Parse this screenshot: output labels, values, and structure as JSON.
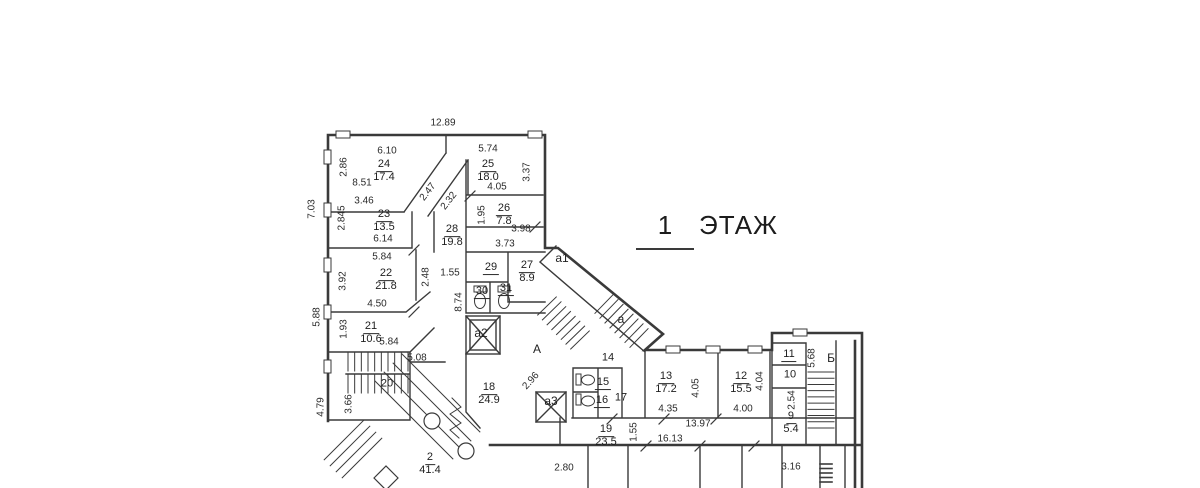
{
  "title": {
    "number": "1",
    "word": "ЭТАЖ"
  },
  "colors": {
    "background": "#ffffff",
    "line": "#3a3a3a",
    "text": "#2a2a2a"
  },
  "plan": {
    "rooms": [
      {
        "n": "24",
        "a": "17.4",
        "x": 384,
        "y": 169
      },
      {
        "n": "25",
        "a": "18.0",
        "x": 488,
        "y": 169
      },
      {
        "n": "23",
        "a": "13.5",
        "x": 384,
        "y": 219
      },
      {
        "n": "26",
        "a": "7.8",
        "x": 504,
        "y": 213
      },
      {
        "n": "28",
        "a": "19.8",
        "x": 452,
        "y": 234
      },
      {
        "n": "22",
        "a": "21.8",
        "x": 386,
        "y": 278
      },
      {
        "n": "21",
        "a": "10.6",
        "x": 371,
        "y": 331
      },
      {
        "n": "27",
        "a": "8.9",
        "x": 527,
        "y": 270
      },
      {
        "n": "29",
        "a": null,
        "u": true,
        "x": 491,
        "y": 266
      },
      {
        "n": "30",
        "a": null,
        "u": true,
        "x": 482,
        "y": 290
      },
      {
        "n": "31",
        "a": null,
        "u": true,
        "x": 506,
        "y": 287
      },
      {
        "n": "20",
        "a": null,
        "x": 387,
        "y": 382
      },
      {
        "n": "18",
        "a": "24.9",
        "x": 489,
        "y": 392
      },
      {
        "n": "2",
        "a": "41.4",
        "x": 430,
        "y": 462
      },
      {
        "n": "14",
        "a": null,
        "x": 608,
        "y": 356
      },
      {
        "n": "15",
        "a": null,
        "u": true,
        "x": 603,
        "y": 381
      },
      {
        "n": "16",
        "a": null,
        "u": true,
        "x": 602,
        "y": 399
      },
      {
        "n": "17",
        "a": null,
        "x": 621,
        "y": 396
      },
      {
        "n": "13",
        "a": "17.2",
        "x": 666,
        "y": 381
      },
      {
        "n": "12",
        "a": "15.5",
        "x": 741,
        "y": 381
      },
      {
        "n": "19",
        "a": "23.5",
        "x": 606,
        "y": 434
      },
      {
        "n": "11",
        "a": null,
        "u": true,
        "x": 789,
        "y": 353
      },
      {
        "n": "10",
        "a": null,
        "x": 790,
        "y": 373
      },
      {
        "n": "9",
        "a": "5.4",
        "x": 791,
        "y": 421
      }
    ],
    "dims": [
      {
        "t": "12.89",
        "x": 443,
        "y": 123,
        "r": 0
      },
      {
        "t": "7.03",
        "x": 312,
        "y": 209,
        "r": -90
      },
      {
        "t": "5.88",
        "x": 317,
        "y": 317,
        "r": -90
      },
      {
        "t": "4.79",
        "x": 321,
        "y": 407,
        "r": -90
      },
      {
        "t": "6.10",
        "x": 387,
        "y": 151,
        "r": 0
      },
      {
        "t": "2.86",
        "x": 344,
        "y": 167,
        "r": -90
      },
      {
        "t": "8.51",
        "x": 362,
        "y": 183,
        "r": 0
      },
      {
        "t": "3.46",
        "x": 364,
        "y": 201,
        "r": 0
      },
      {
        "t": "2.845",
        "x": 342,
        "y": 218,
        "r": -90
      },
      {
        "t": "6.14",
        "x": 383,
        "y": 239,
        "r": 0
      },
      {
        "t": "5.84",
        "x": 382,
        "y": 257,
        "r": 0
      },
      {
        "t": "3.92",
        "x": 343,
        "y": 281,
        "r": -90
      },
      {
        "t": "2.48",
        "x": 426,
        "y": 277,
        "r": -90
      },
      {
        "t": "4.50",
        "x": 377,
        "y": 304,
        "r": 0
      },
      {
        "t": "1.93",
        "x": 344,
        "y": 329,
        "r": -90
      },
      {
        "t": "5.84",
        "x": 389,
        "y": 342,
        "r": 0
      },
      {
        "t": "5.08",
        "x": 417,
        "y": 358,
        "r": 0
      },
      {
        "t": "3.66",
        "x": 349,
        "y": 404,
        "r": -90
      },
      {
        "t": "2.47",
        "x": 428,
        "y": 192,
        "r": -52
      },
      {
        "t": "2.32",
        "x": 449,
        "y": 201,
        "r": -52
      },
      {
        "t": "5.74",
        "x": 488,
        "y": 149,
        "r": 0
      },
      {
        "t": "3.37",
        "x": 527,
        "y": 172,
        "r": -90
      },
      {
        "t": "4.05",
        "x": 497,
        "y": 187,
        "r": 0
      },
      {
        "t": "1.95",
        "x": 482,
        "y": 215,
        "r": -90
      },
      {
        "t": "3.98",
        "x": 521,
        "y": 229,
        "r": 0
      },
      {
        "t": "3.73",
        "x": 505,
        "y": 244,
        "r": 0
      },
      {
        "t": "1.55",
        "x": 450,
        "y": 273,
        "r": 0
      },
      {
        "t": "8.74",
        "x": 459,
        "y": 302,
        "r": -90
      },
      {
        "t": "2.96",
        "x": 531,
        "y": 381,
        "r": -48
      },
      {
        "t": "1.55",
        "x": 634,
        "y": 432,
        "r": -90
      },
      {
        "t": "16.13",
        "x": 670,
        "y": 439,
        "r": 0
      },
      {
        "t": "13.97",
        "x": 698,
        "y": 424,
        "r": 0
      },
      {
        "t": "4.05",
        "x": 696,
        "y": 388,
        "r": -90
      },
      {
        "t": "4.35",
        "x": 668,
        "y": 409,
        "r": 0
      },
      {
        "t": "4.04",
        "x": 760,
        "y": 381,
        "r": -90
      },
      {
        "t": "4.00",
        "x": 743,
        "y": 409,
        "r": 0
      },
      {
        "t": "2.54",
        "x": 792,
        "y": 400,
        "r": -90
      },
      {
        "t": "5.68",
        "x": 812,
        "y": 358,
        "r": -90
      },
      {
        "t": "2.80",
        "x": 564,
        "y": 468,
        "r": 0
      },
      {
        "t": "3.16",
        "x": 791,
        "y": 467,
        "r": 0
      }
    ],
    "markers": [
      {
        "t": "А",
        "x": 537,
        "y": 349
      },
      {
        "t": "Б",
        "x": 831,
        "y": 358
      },
      {
        "t": "а",
        "x": 621,
        "y": 319
      },
      {
        "t": "а1",
        "x": 562,
        "y": 258
      },
      {
        "t": "а2",
        "x": 481,
        "y": 333
      },
      {
        "t": "а3",
        "x": 551,
        "y": 401
      }
    ]
  }
}
